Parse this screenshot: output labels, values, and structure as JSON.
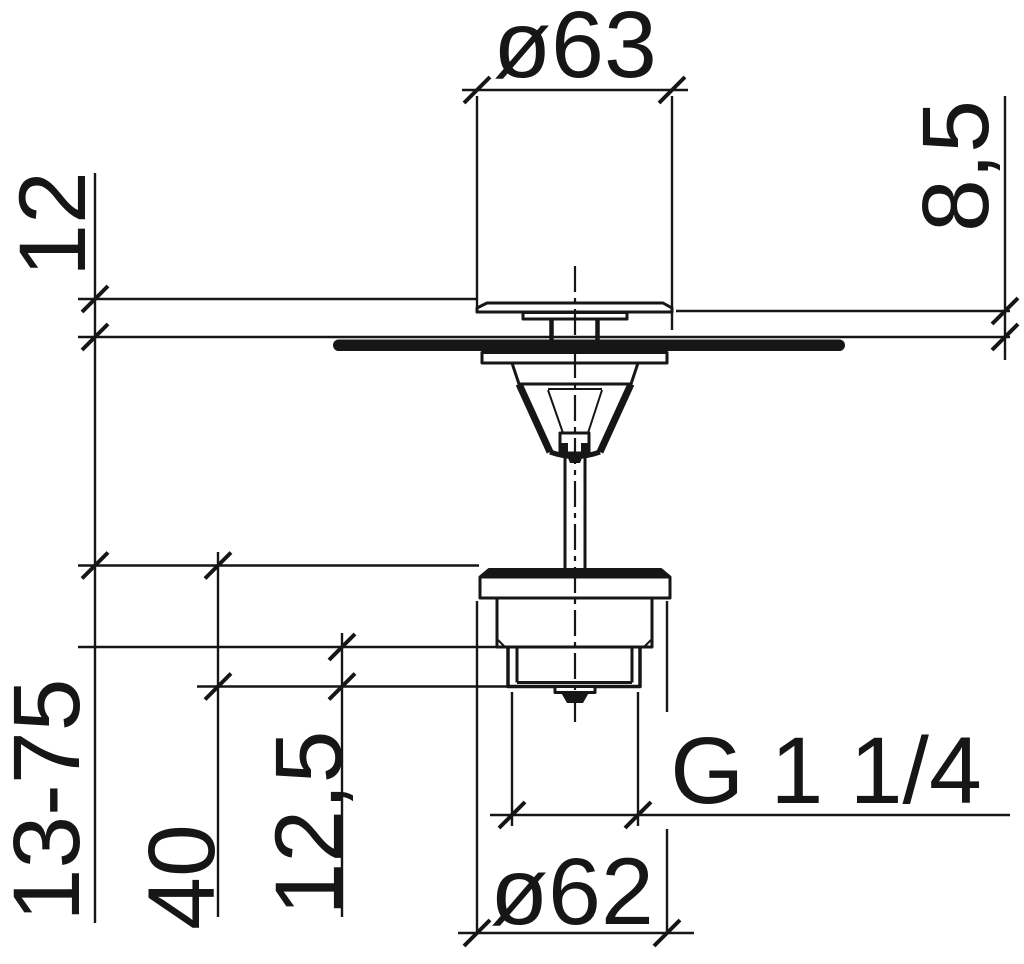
{
  "colors": {
    "ink": "#161616",
    "paper": "#ffffff"
  },
  "dimensions": [
    {
      "id": "cap-diameter",
      "label": "ø63"
    },
    {
      "id": "cap-height-above-deck",
      "label": "8,5"
    },
    {
      "id": "lift-height",
      "label": "12"
    },
    {
      "id": "clamping-range",
      "label": "13-75"
    },
    {
      "id": "body-height",
      "label": "40"
    },
    {
      "id": "thread-length",
      "label": "12,5"
    },
    {
      "id": "thread-size",
      "label": "G 1 1/4"
    },
    {
      "id": "body-diameter",
      "label": "ø62"
    }
  ]
}
